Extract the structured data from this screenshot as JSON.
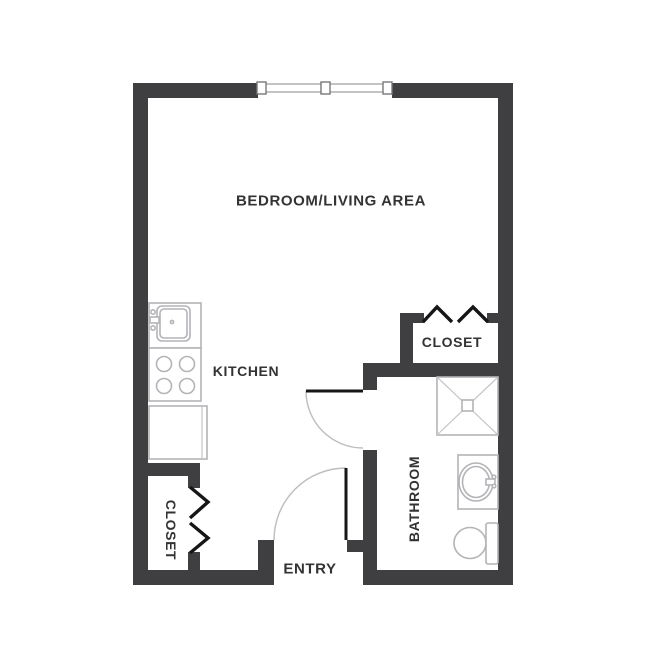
{
  "plan": {
    "type": "studio-apartment-floor-plan",
    "labels": {
      "bedroom_living": "BEDROOM/LIVING AREA",
      "kitchen": "KITCHEN",
      "closet_right": "CLOSET",
      "bathroom": "BATHROOM",
      "closet_left": "CLOSET",
      "entry": "ENTRY"
    },
    "fixtures": [
      "window",
      "kitchen-sink",
      "stove-4-burner",
      "kitchen-counter",
      "shower",
      "vanity-sink",
      "toilet",
      "bifold-doors-closet-right",
      "bifold-doors-closet-left",
      "swing-door-bathroom",
      "swing-door-entry"
    ],
    "colors": {
      "background": "#ffffff",
      "wall": "#3f3f41",
      "door_leaf": "#161616",
      "door_arc": "#bdbdbd",
      "fixture_outline": "#b4b4b8",
      "text": "#333335"
    }
  }
}
